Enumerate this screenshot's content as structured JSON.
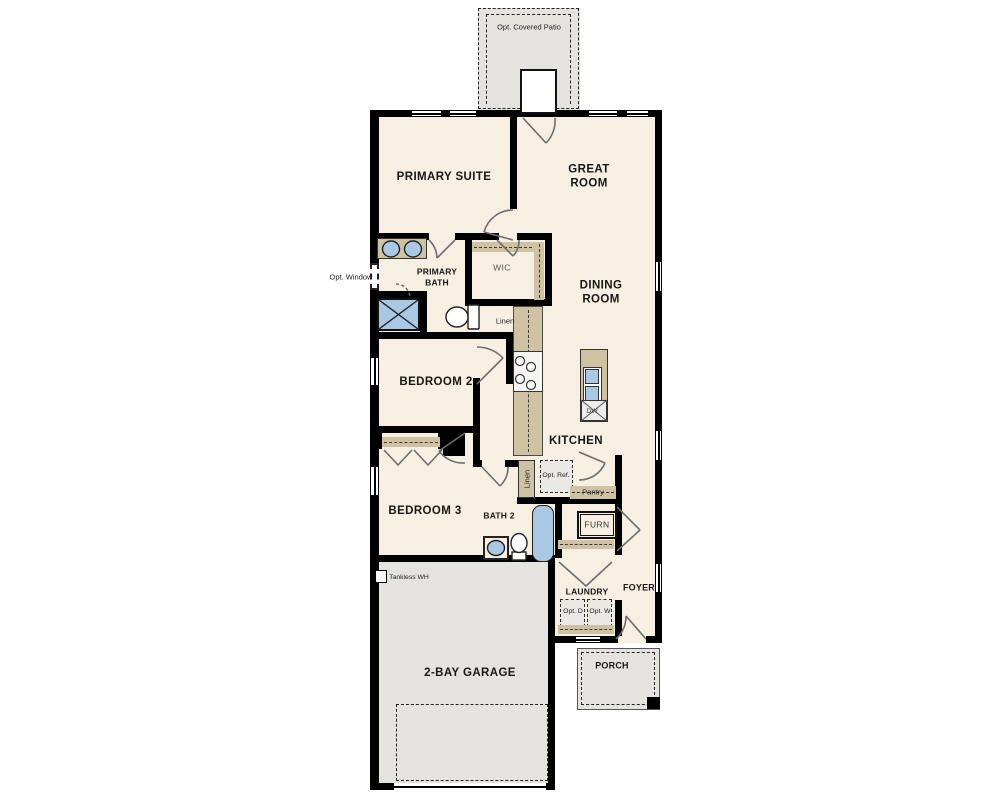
{
  "plan_title": "Single-story floor plan",
  "rooms": [
    {
      "id": "primary-suite",
      "label": "PRIMARY SUITE"
    },
    {
      "id": "great-room",
      "label": "GREAT ROOM"
    },
    {
      "id": "primary-bath",
      "label": "PRIMARY BATH"
    },
    {
      "id": "wic",
      "label": "WIC"
    },
    {
      "id": "dining-room",
      "label": "DINING ROOM"
    },
    {
      "id": "bedroom-2",
      "label": "BEDROOM 2"
    },
    {
      "id": "kitchen",
      "label": "KITCHEN"
    },
    {
      "id": "bedroom-3",
      "label": "BEDROOM 3"
    },
    {
      "id": "bath-2",
      "label": "BATH 2"
    },
    {
      "id": "laundry",
      "label": "LAUNDRY"
    },
    {
      "id": "foyer",
      "label": "FOYER"
    },
    {
      "id": "garage",
      "label": "2-BAY GARAGE"
    },
    {
      "id": "porch",
      "label": "PORCH"
    }
  ],
  "annotations": {
    "patio": "Opt. Covered Patio",
    "opt_window": "Opt. Window",
    "linen_bath": "Linen",
    "linen_hall": "Linen",
    "opt_ref": "Opt. Ref.",
    "pantry": "Pantry",
    "furnace": "FURN",
    "tankless": "Tankless WH",
    "opt_dryer": "Opt. D",
    "opt_washer": "Opt. W",
    "dishwasher": "DW"
  },
  "colors": {
    "wall": "#000000",
    "cream": "#f7efe2",
    "gray": "#e4e3e0",
    "tan": "#cfc2a3",
    "blue": "#a9c8e4",
    "line": "#6d6d6d"
  }
}
